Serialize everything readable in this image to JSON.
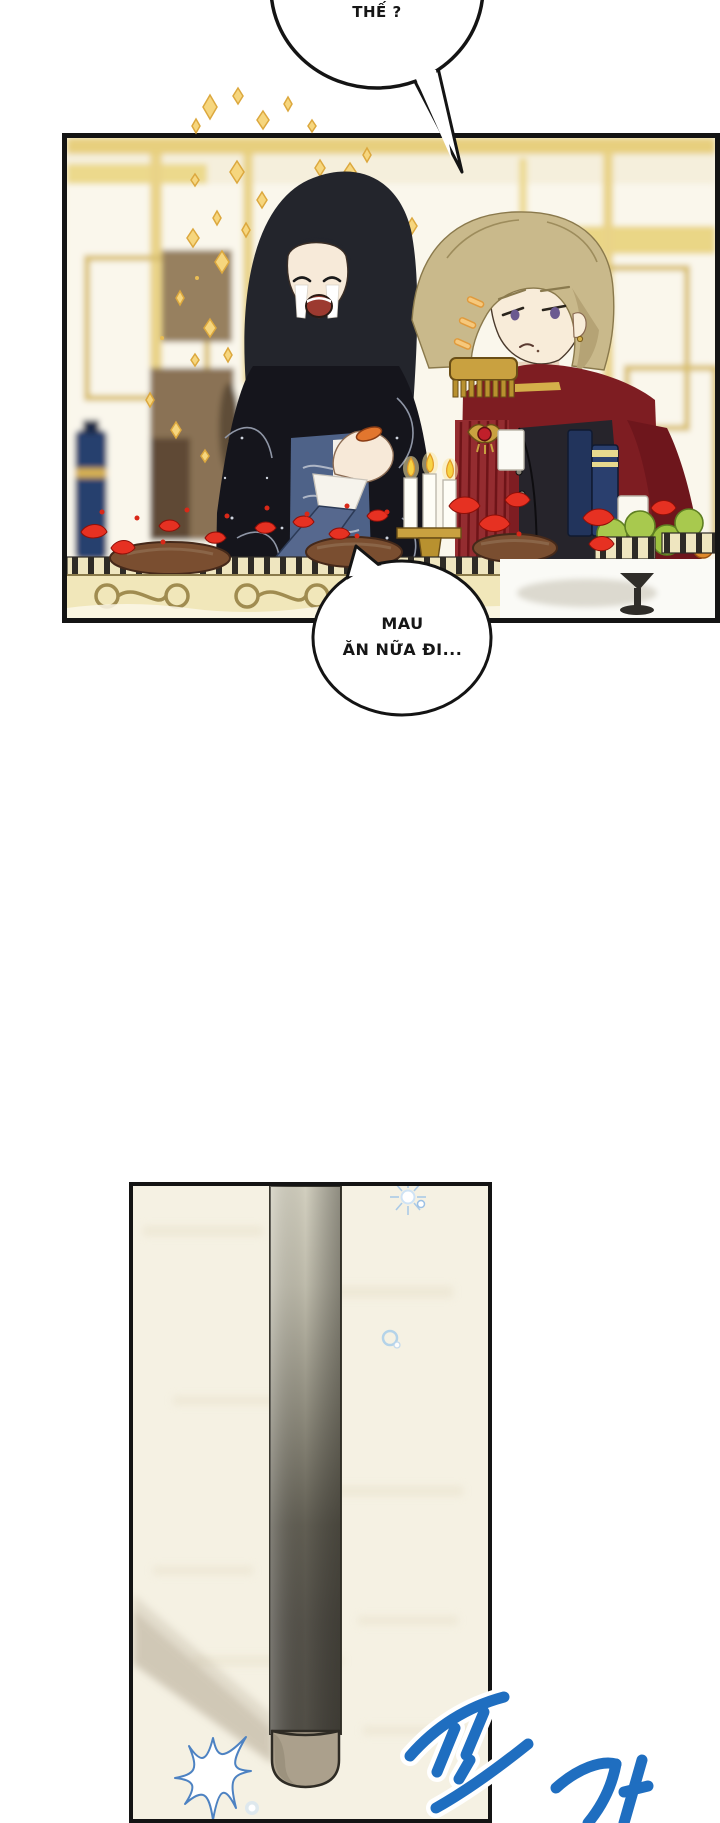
{
  "speech": {
    "top_bubble": "THẾ ?",
    "bottom_bubble_line1": "MAU",
    "bottom_bubble_line2": "ĂN NỮA ĐI..."
  },
  "sfx": {
    "glyph1": "또",
    "glyph2": "가",
    "style": "blue brush sound-effect lettering, white outlined",
    "color": "#1f6ec0"
  },
  "scene": {
    "panel1": "two characters dining at a banquet table in a gold palace hall",
    "panel2": "a cane standing on a pale floor with blue sparkles"
  },
  "colors": {
    "panel_border": "#141414",
    "wall_gold": "#e7cf7e",
    "wall_cream": "#faf7ec",
    "sparkle_gold": "#f6d67e",
    "petal_red": "#e63122",
    "cloak_dark": "#15151c",
    "jacket_blue": "#4e6288",
    "coat_red": "#7e1d22",
    "hair_blonde": "#c9b98b",
    "pole_dark": "#55524a",
    "pole_tip": "#aba08c",
    "sfx_blue": "#1f6ec0"
  }
}
